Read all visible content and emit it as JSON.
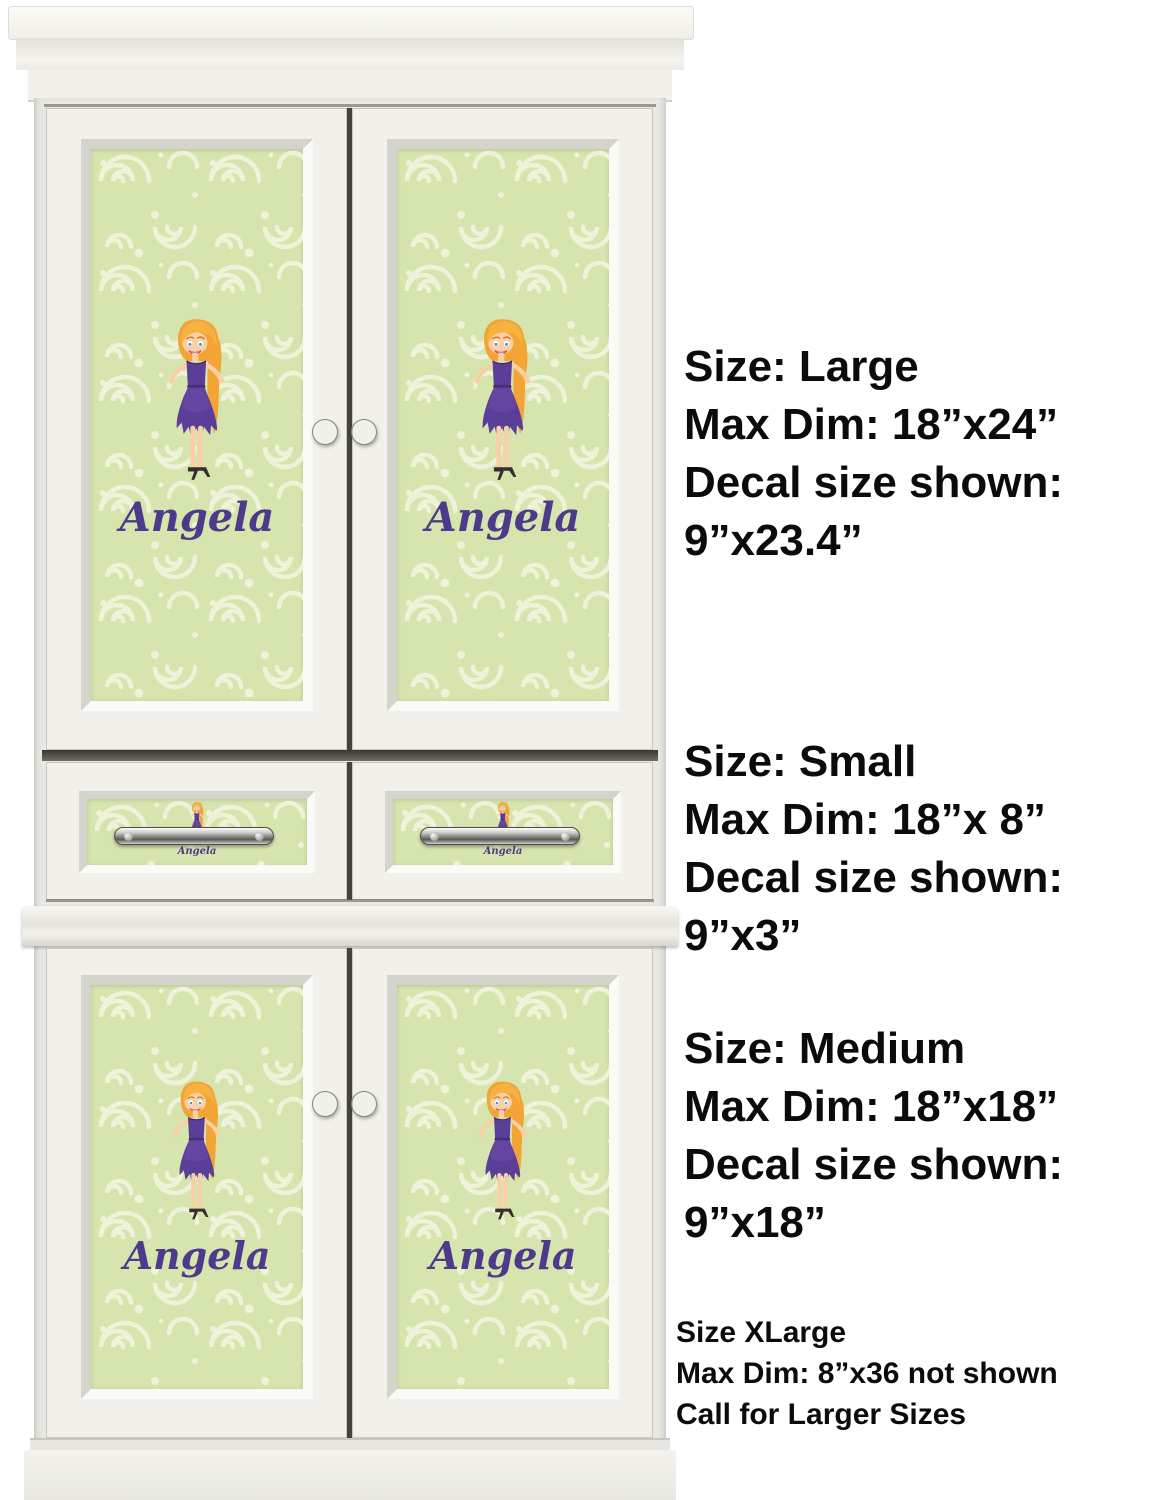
{
  "decal": {
    "name": "Angela",
    "name_color": "#4e3a8b",
    "background_color": "#d6e4ae",
    "swirl_color": "#eef2d8"
  },
  "character": {
    "description": "cartoon girl with long orange hair, purple strapless dress, black high heels",
    "hair_color": "#f2a434",
    "dress_color": "#5b3e97",
    "skin_color": "#f9d0a6",
    "shoe_color": "#332f2b"
  },
  "cabinet": {
    "description": "white armoire with two upper decal doors, two decal drawers and two lower decal doors",
    "wood_color": "#f1f0ea",
    "hardware_color": "#8f8f8c"
  },
  "size_annotations": [
    {
      "id": "large",
      "lines": [
        "Size: Large",
        "Max Dim: 18”x24”",
        "Decal size shown:",
        "9”x23.4”"
      ]
    },
    {
      "id": "small",
      "lines": [
        "Size: Small",
        "Max Dim: 18”x 8”",
        "Decal size shown:",
        "9”x3”"
      ]
    },
    {
      "id": "medium",
      "lines": [
        "Size: Medium",
        "Max Dim: 18”x18”",
        "Decal size shown:",
        "9”x18”"
      ]
    },
    {
      "id": "xlarge",
      "lines": [
        "Size XLarge",
        "Max Dim: 8”x36 not shown",
        "Call for Larger Sizes"
      ]
    }
  ]
}
